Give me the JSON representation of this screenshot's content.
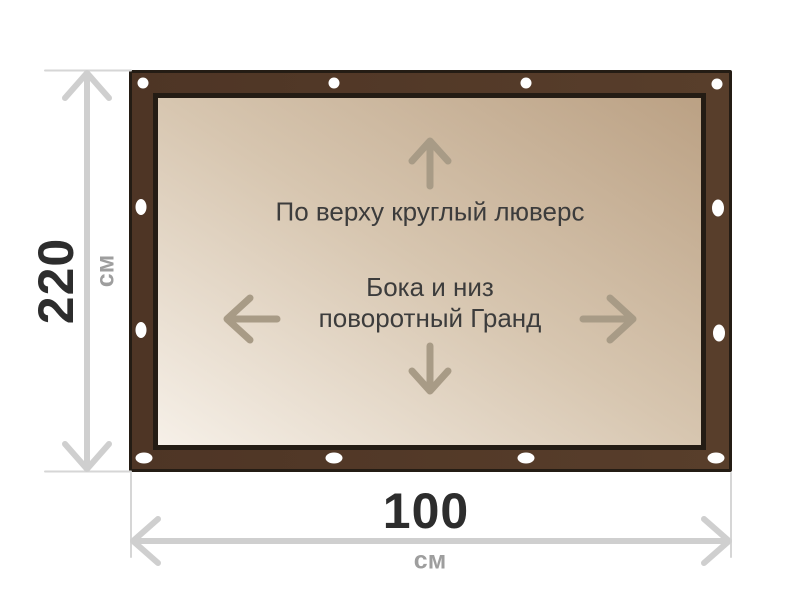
{
  "banner": {
    "note_top": "По верху круглый люверс",
    "note_center_line1": "Бока и низ",
    "note_center_line2": "поворотный Гранд"
  },
  "dimensions": {
    "height": {
      "value": "220",
      "unit": "см"
    },
    "width": {
      "value": "100",
      "unit": "см"
    }
  },
  "icons": {
    "up_arrow": "↑",
    "down_arrow": "↓",
    "left_arrow": "←",
    "right_arrow": "→",
    "grommet": "white oval eyelet"
  },
  "colors": {
    "frame_brown": "#543a29",
    "frame_outline": "#241c14",
    "panel_light": "#f6f0e8",
    "panel_dark": "#bba184",
    "panel_text": "#3c3c3c",
    "panel_arrow": "#a89b86",
    "dimension_line": "#cfcfcf",
    "value_text": "#2d2d2d",
    "unit_text": "#9e9e9e",
    "grommet_white": "#ffffff"
  }
}
